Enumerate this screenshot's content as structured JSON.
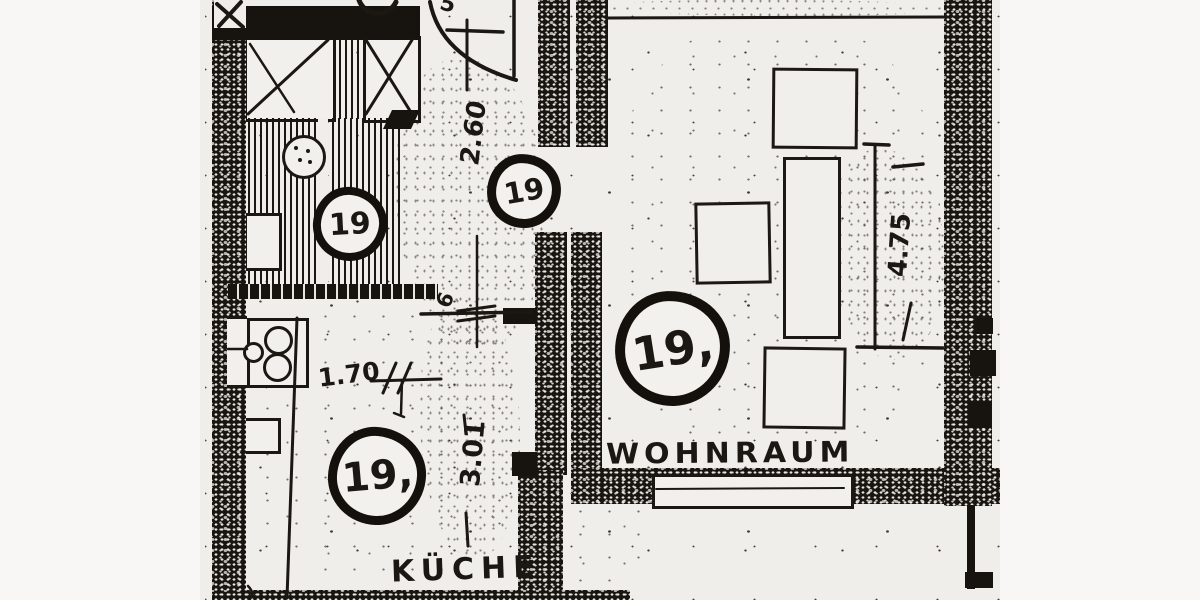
{
  "plan": {
    "rooms": {
      "living_room_label": "WOHNRAUM",
      "kitchen_label": "KÜCHE"
    },
    "unit_markers": {
      "kitchen_upper": "19",
      "hall_doorway": "19",
      "kitchen_main": "19,",
      "living_room": "19,"
    },
    "dimensions": {
      "hall_width": "2.60",
      "kitchen_length": "3.01",
      "kitchen_counter": "1.70",
      "living_room_depth": "4.75",
      "opening_note": "6",
      "edge_partial": "5"
    },
    "colors": {
      "ink": "#1b1712",
      "paper": "#f0eeea"
    }
  }
}
